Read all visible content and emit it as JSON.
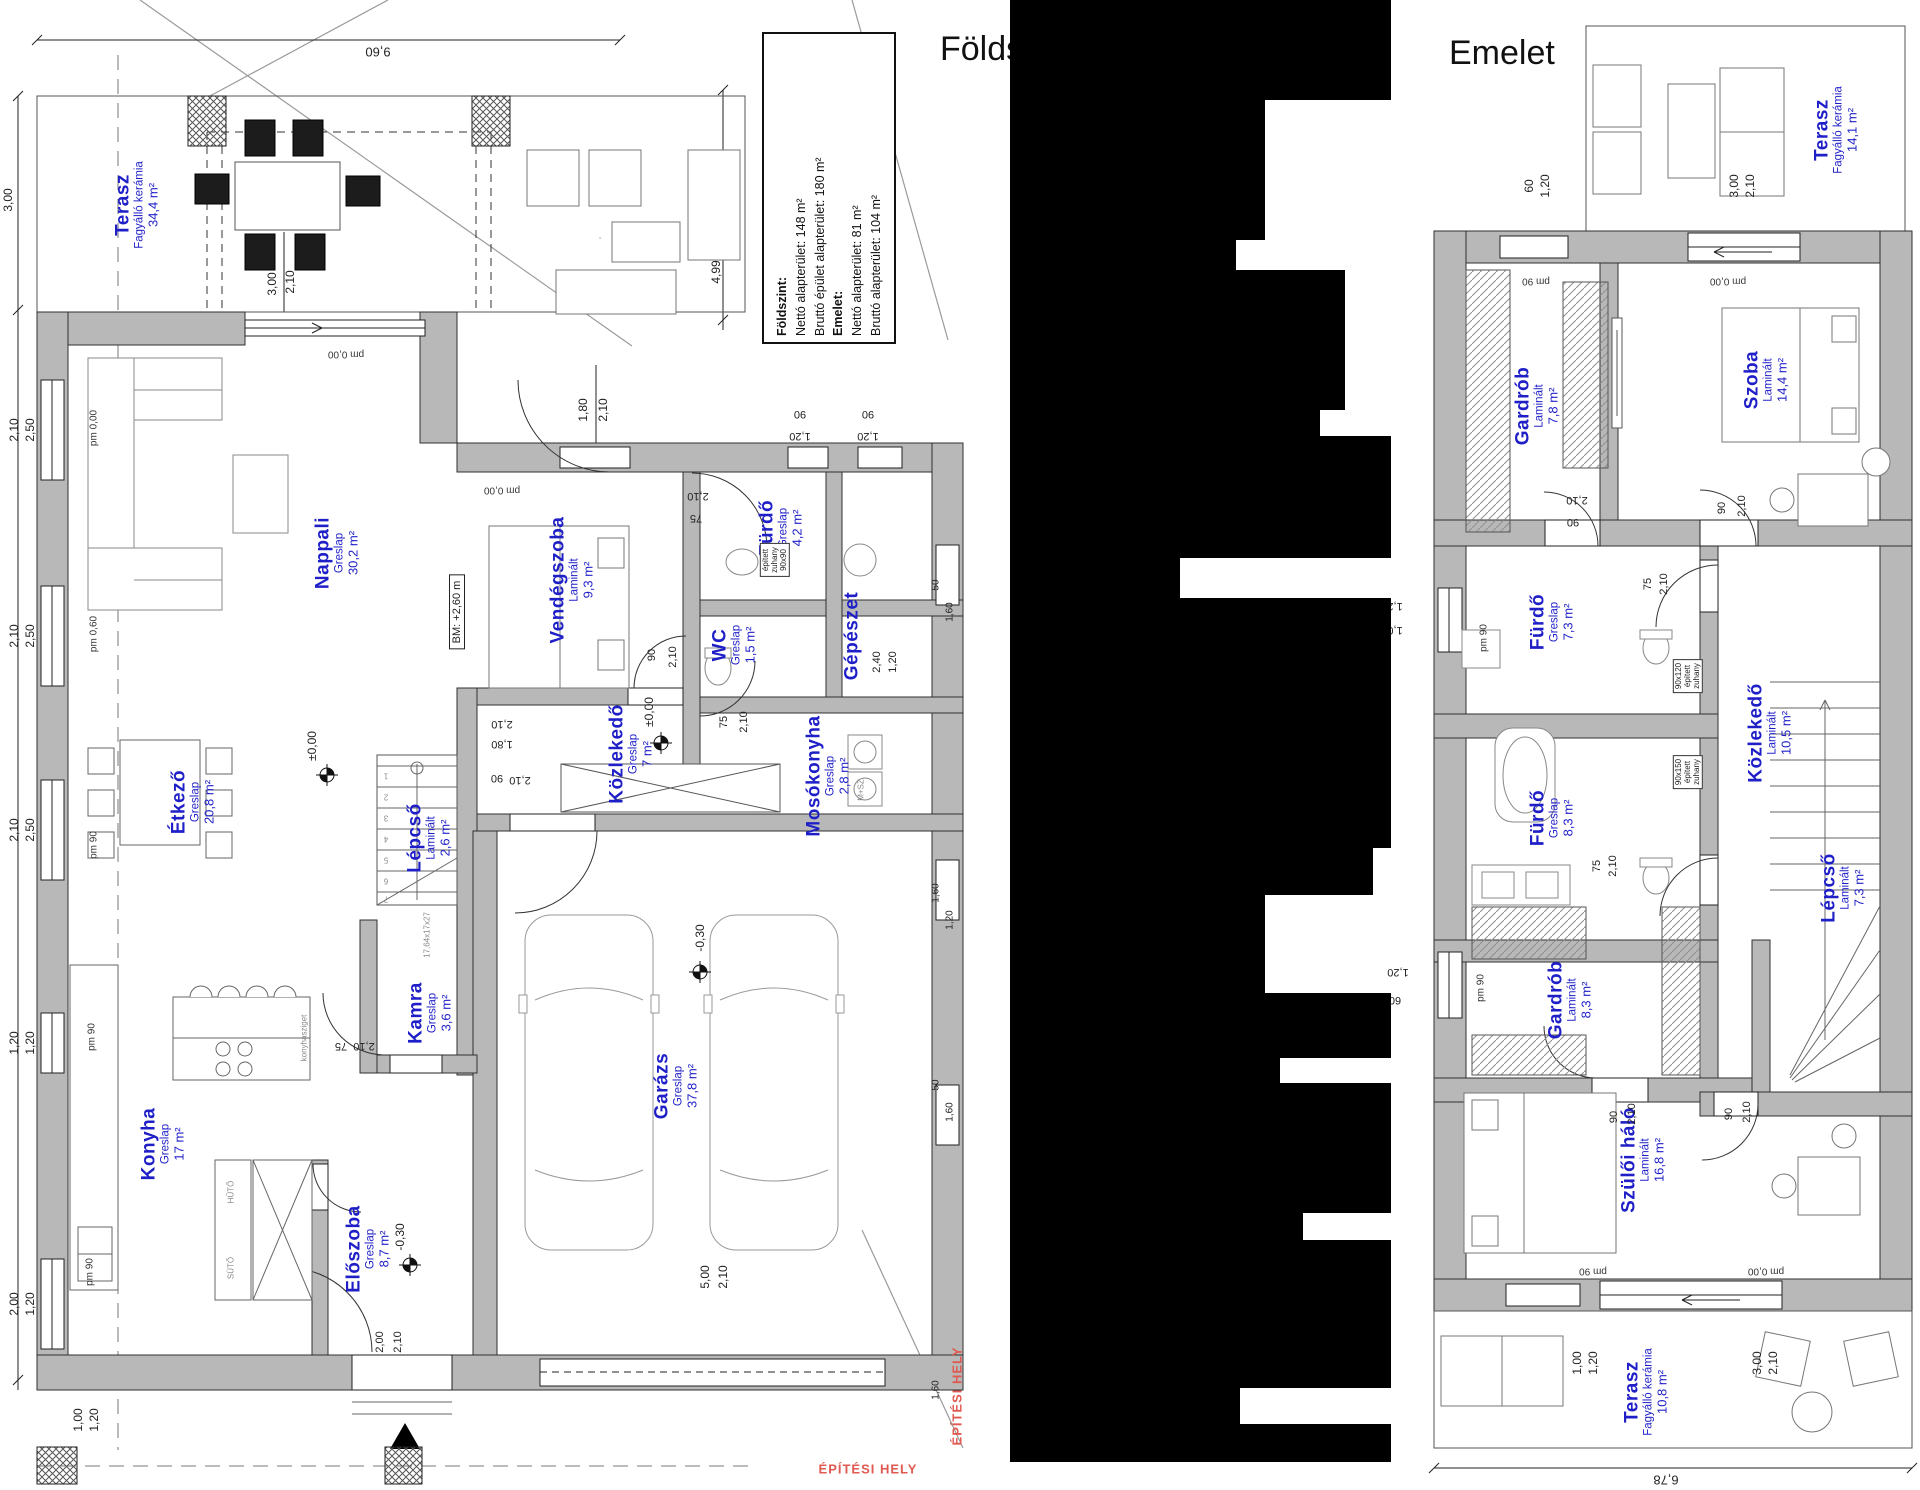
{
  "ground_floor": {
    "title": "Földszint",
    "summary_box": {
      "lines": [
        "Földszint:",
        "Nettó alapterület: 148 m²",
        "Bruttó épület alapterület: 180 m²",
        "Emelet:",
        "Nettó alapterület: 81 m²",
        "Bruttó alapterület: 104 m²"
      ]
    },
    "rooms": [
      {
        "name": "Terasz",
        "material": "Fagyálló kerámia",
        "area": "34,4 m²",
        "x": 137,
        "y": 205
      },
      {
        "name": "Nappali",
        "material": "Greslap",
        "area": "30,2 m²",
        "x": 337,
        "y": 553
      },
      {
        "name": "Vendégszoba",
        "material": "Laminált",
        "area": "9,3 m²",
        "x": 572,
        "y": 580
      },
      {
        "name": "Fürdő",
        "material": "Greslap",
        "area": "4,2 m²",
        "x": 781,
        "y": 528
      },
      {
        "name": "WC",
        "material": "Greslap",
        "area": "1,5 m²",
        "x": 734,
        "y": 645
      },
      {
        "name": "Gépészet",
        "material": "",
        "area": "",
        "x": 852,
        "y": 636
      },
      {
        "name": "Mosókonyha",
        "material": "Greslap",
        "area": "2,8 m²",
        "x": 828,
        "y": 776
      },
      {
        "name": "Közlekedő",
        "material": "Greslap",
        "area": "7 m²",
        "x": 631,
        "y": 754
      },
      {
        "name": "Étkező",
        "material": "Greslap",
        "area": "20,8 m²",
        "x": 193,
        "y": 802
      },
      {
        "name": "Lépcső",
        "material": "Laminált",
        "area": "2,6 m²",
        "x": 429,
        "y": 838
      },
      {
        "name": "Kamra",
        "material": "Greslap",
        "area": "3,6 m²",
        "x": 430,
        "y": 1013
      },
      {
        "name": "Garázs",
        "material": "Greslap",
        "area": "37,8 m²",
        "x": 676,
        "y": 1086
      },
      {
        "name": "Konyha",
        "material": "Greslap",
        "area": "17 m²",
        "x": 163,
        "y": 1144
      },
      {
        "name": "Előszoba",
        "material": "Greslap",
        "area": "8,7 m²",
        "x": 368,
        "y": 1249
      }
    ],
    "annotations": [
      {
        "t": "9,60",
        "x": 378,
        "y": 52,
        "r": 180,
        "s": 13
      },
      {
        "t": "3,00",
        "x": 8,
        "y": 200,
        "r": -90,
        "s": 12
      },
      {
        "t": "4,99",
        "x": 716,
        "y": 272,
        "r": -90,
        "s": 12
      },
      {
        "t": "3,00",
        "x": 272,
        "y": 284,
        "r": -90,
        "s": 12
      },
      {
        "t": "2,10",
        "x": 290,
        "y": 282,
        "r": -90,
        "s": 12
      },
      {
        "t": "pm 0,00",
        "x": 346,
        "y": 354,
        "r": 180,
        "s": 10,
        "c": "pm"
      },
      {
        "t": "1,80",
        "x": 583,
        "y": 410,
        "r": -90,
        "s": 12
      },
      {
        "t": "2,10",
        "x": 603,
        "y": 410,
        "r": -90,
        "s": 12
      },
      {
        "t": "90",
        "x": 800,
        "y": 414,
        "r": 180,
        "s": 11
      },
      {
        "t": "1,20",
        "x": 800,
        "y": 436,
        "r": 180,
        "s": 11
      },
      {
        "t": "90",
        "x": 868,
        "y": 414,
        "r": 180,
        "s": 11
      },
      {
        "t": "1,20",
        "x": 868,
        "y": 436,
        "r": 180,
        "s": 11
      },
      {
        "t": "pm 0,00",
        "x": 502,
        "y": 490,
        "r": 180,
        "s": 10,
        "c": "pm"
      },
      {
        "t": "2,10",
        "x": 698,
        "y": 496,
        "r": 180,
        "s": 11
      },
      {
        "t": "75",
        "x": 696,
        "y": 518,
        "r": 180,
        "s": 11
      },
      {
        "t": "2,10",
        "x": 14,
        "y": 430,
        "r": -90,
        "s": 12
      },
      {
        "t": "2,50",
        "x": 30,
        "y": 430,
        "r": -90,
        "s": 12
      },
      {
        "t": "pm 0,00",
        "x": 94,
        "y": 428,
        "r": -90,
        "s": 10,
        "c": "pm"
      },
      {
        "t": "BM: +2,60 m",
        "x": 457,
        "y": 612,
        "r": -90,
        "s": 11,
        "b": 1
      },
      {
        "t": "2,10",
        "x": 14,
        "y": 636,
        "r": -90,
        "s": 12
      },
      {
        "t": "2,50",
        "x": 30,
        "y": 636,
        "r": -90,
        "s": 12
      },
      {
        "t": "pm 0,60",
        "x": 94,
        "y": 634,
        "r": -90,
        "s": 10,
        "c": "pm"
      },
      {
        "t": "90",
        "x": 652,
        "y": 655,
        "r": -90,
        "s": 11
      },
      {
        "t": "2,10",
        "x": 673,
        "y": 657,
        "r": -90,
        "s": 11
      },
      {
        "t": "75",
        "x": 724,
        "y": 722,
        "r": -90,
        "s": 11
      },
      {
        "t": "2,10",
        "x": 744,
        "y": 722,
        "r": -90,
        "s": 11
      },
      {
        "t": "2,40",
        "x": 877,
        "y": 662,
        "r": -90,
        "s": 11
      },
      {
        "t": "1,20",
        "x": 893,
        "y": 662,
        "r": -90,
        "s": 11
      },
      {
        "t": "50",
        "x": 936,
        "y": 585,
        "r": -90,
        "s": 10
      },
      {
        "t": "1,60",
        "x": 950,
        "y": 612,
        "r": -90,
        "s": 10
      },
      {
        "t": "±0,00",
        "x": 649,
        "y": 712,
        "r": -90,
        "s": 12
      },
      {
        "t": "±0,00",
        "x": 312,
        "y": 746,
        "r": -90,
        "s": 12
      },
      {
        "t": "2,10",
        "x": 502,
        "y": 724,
        "r": 180,
        "s": 11
      },
      {
        "t": "1,80",
        "x": 502,
        "y": 744,
        "r": 180,
        "s": 11
      },
      {
        "t": "90",
        "x": 497,
        "y": 778,
        "r": 180,
        "s": 11
      },
      {
        "t": "2,10",
        "x": 520,
        "y": 780,
        "r": 180,
        "s": 11
      },
      {
        "t": "M+SZ",
        "x": 861,
        "y": 790,
        "r": -90,
        "s": 8,
        "c": "gray"
      },
      {
        "t": "2,10",
        "x": 14,
        "y": 830,
        "r": -90,
        "s": 12
      },
      {
        "t": "2,50",
        "x": 30,
        "y": 830,
        "r": -90,
        "s": 12
      },
      {
        "t": "pm 90",
        "x": 94,
        "y": 845,
        "r": -90,
        "s": 10,
        "c": "pm"
      },
      {
        "t": "1",
        "x": 386,
        "y": 776,
        "r": 180,
        "s": 8,
        "c": "gray"
      },
      {
        "t": "2",
        "x": 386,
        "y": 797,
        "r": 180,
        "s": 8,
        "c": "gray"
      },
      {
        "t": "3",
        "x": 386,
        "y": 818,
        "r": 180,
        "s": 8,
        "c": "gray"
      },
      {
        "t": "4",
        "x": 386,
        "y": 839,
        "r": 180,
        "s": 8,
        "c": "gray"
      },
      {
        "t": "5",
        "x": 386,
        "y": 860,
        "r": 180,
        "s": 8,
        "c": "gray"
      },
      {
        "t": "6",
        "x": 386,
        "y": 881,
        "r": 180,
        "s": 8,
        "c": "gray"
      },
      {
        "t": "7",
        "x": 386,
        "y": 899,
        "r": 180,
        "s": 8,
        "c": "gray"
      },
      {
        "t": "17,64x17x27",
        "x": 427,
        "y": 935,
        "r": -90,
        "s": 8,
        "c": "gray"
      },
      {
        "t": "-0,30",
        "x": 700,
        "y": 938,
        "r": -90,
        "s": 12
      },
      {
        "t": "1,60",
        "x": 936,
        "y": 893,
        "r": -90,
        "s": 10
      },
      {
        "t": "1,20",
        "x": 950,
        "y": 920,
        "r": -90,
        "s": 10
      },
      {
        "t": "75",
        "x": 341,
        "y": 1046,
        "r": 180,
        "s": 11
      },
      {
        "t": "2,10",
        "x": 364,
        "y": 1046,
        "r": 180,
        "s": 11
      },
      {
        "t": "1,20",
        "x": 14,
        "y": 1043,
        "r": -90,
        "s": 12
      },
      {
        "t": "1,20",
        "x": 30,
        "y": 1043,
        "r": -90,
        "s": 12
      },
      {
        "t": "pm 90",
        "x": 92,
        "y": 1037,
        "r": -90,
        "s": 10,
        "c": "pm"
      },
      {
        "t": "konyhasziget",
        "x": 304,
        "y": 1038,
        "r": -90,
        "s": 8,
        "c": "gray"
      },
      {
        "t": "HŰTŐ",
        "x": 231,
        "y": 1192,
        "r": -90,
        "s": 8,
        "c": "gray"
      },
      {
        "t": "SÜTŐ",
        "x": 231,
        "y": 1268,
        "r": -90,
        "s": 8,
        "c": "gray"
      },
      {
        "t": "50",
        "x": 936,
        "y": 1085,
        "r": -90,
        "s": 10
      },
      {
        "t": "1,60",
        "x": 950,
        "y": 1112,
        "r": -90,
        "s": 10
      },
      {
        "t": "-0,30",
        "x": 400,
        "y": 1237,
        "r": -90,
        "s": 12
      },
      {
        "t": "5,00",
        "x": 705,
        "y": 1277,
        "r": -90,
        "s": 12
      },
      {
        "t": "2,10",
        "x": 723,
        "y": 1277,
        "r": -90,
        "s": 12
      },
      {
        "t": "2,00",
        "x": 14,
        "y": 1304,
        "r": -90,
        "s": 12
      },
      {
        "t": "1,20",
        "x": 30,
        "y": 1304,
        "r": -90,
        "s": 12
      },
      {
        "t": "pm 90",
        "x": 90,
        "y": 1272,
        "r": -90,
        "s": 10,
        "c": "pm"
      },
      {
        "t": "2,00",
        "x": 380,
        "y": 1342,
        "r": -90,
        "s": 11
      },
      {
        "t": "2,10",
        "x": 398,
        "y": 1342,
        "r": -90,
        "s": 11
      },
      {
        "t": "1,00",
        "x": 78,
        "y": 1420,
        "r": -90,
        "s": 12
      },
      {
        "t": "1,20",
        "x": 94,
        "y": 1420,
        "r": -90,
        "s": 12
      },
      {
        "t": "1,60",
        "x": 936,
        "y": 1390,
        "r": -90,
        "s": 10
      },
      {
        "t": "ÉPÍTÉSI HELY",
        "x": 957,
        "y": 1396,
        "r": -90,
        "s": 13,
        "c": "red"
      },
      {
        "t": "ÉPÍTÉSI HELY",
        "x": 868,
        "y": 1469,
        "r": 0,
        "s": 13,
        "c": "red"
      },
      {
        "lines": [
          "épített",
          "zuhany",
          "90x90"
        ],
        "x": 775,
        "y": 560,
        "r": -90,
        "s": 8
      }
    ]
  },
  "upper_floor": {
    "title": "Emelet",
    "rooms": [
      {
        "name": "Terasz",
        "material": "Fagyálló kerámia",
        "area": "14,1 m²",
        "x": 1836,
        "y": 130
      },
      {
        "name": "Gardrób",
        "material": "Laminált",
        "area": "7,8 m²",
        "x": 1537,
        "y": 406
      },
      {
        "name": "Szoba",
        "material": "Laminált",
        "area": "14,4 m²",
        "x": 1766,
        "y": 380
      },
      {
        "name": "Fürdő",
        "material": "Greslap",
        "area": "7,3 m²",
        "x": 1552,
        "y": 622
      },
      {
        "name": "Közlekedő",
        "material": "Laminált",
        "area": "10,5 m²",
        "x": 1770,
        "y": 733
      },
      {
        "name": "Fürdő",
        "material": "Greslap",
        "area": "8,3 m²",
        "x": 1552,
        "y": 818
      },
      {
        "name": "Lépcső",
        "material": "Laminált",
        "area": "7,3 m²",
        "x": 1843,
        "y": 888
      },
      {
        "name": "Gardrób",
        "material": "Laminált",
        "area": "8,3 m²",
        "x": 1570,
        "y": 1000
      },
      {
        "name": "Szülői háló",
        "material": "Laminált",
        "area": "16,8 m²",
        "x": 1643,
        "y": 1160
      },
      {
        "name": "Terasz",
        "material": "Fagyálló kerámia",
        "area": "10,8 m²",
        "x": 1646,
        "y": 1392
      }
    ],
    "annotations": [
      {
        "t": "60",
        "x": 1529,
        "y": 186,
        "r": -90,
        "s": 12
      },
      {
        "t": "1,20",
        "x": 1545,
        "y": 186,
        "r": -90,
        "s": 12
      },
      {
        "t": "3,00",
        "x": 1734,
        "y": 186,
        "r": -90,
        "s": 12
      },
      {
        "t": "2,10",
        "x": 1750,
        "y": 186,
        "r": -90,
        "s": 12
      },
      {
        "t": "pm 90",
        "x": 1536,
        "y": 281,
        "r": 180,
        "s": 10,
        "c": "pm"
      },
      {
        "t": "pm 0,00",
        "x": 1728,
        "y": 281,
        "r": 180,
        "s": 10,
        "c": "pm"
      },
      {
        "t": "2,10",
        "x": 1577,
        "y": 500,
        "r": 180,
        "s": 11
      },
      {
        "t": "90",
        "x": 1573,
        "y": 522,
        "r": 180,
        "s": 11
      },
      {
        "t": "90",
        "x": 1722,
        "y": 508,
        "r": -90,
        "s": 11
      },
      {
        "t": "2,10",
        "x": 1742,
        "y": 506,
        "r": -90,
        "s": 11
      },
      {
        "t": "75",
        "x": 1648,
        "y": 584,
        "r": -90,
        "s": 11
      },
      {
        "t": "2,10",
        "x": 1664,
        "y": 584,
        "r": -90,
        "s": 11
      },
      {
        "t": "1,20",
        "x": 1392,
        "y": 606,
        "r": 180,
        "s": 11
      },
      {
        "t": "1,00",
        "x": 1392,
        "y": 630,
        "r": 180,
        "s": 11
      },
      {
        "t": "pm 90",
        "x": 1484,
        "y": 638,
        "r": -90,
        "s": 10,
        "c": "pm"
      },
      {
        "lines": [
          "90x120",
          "épített",
          "zuhany"
        ],
        "x": 1688,
        "y": 676,
        "r": -90,
        "s": 8
      },
      {
        "lines": [
          "90x150",
          "épített",
          "zuhany"
        ],
        "x": 1688,
        "y": 772,
        "r": -90,
        "s": 8
      },
      {
        "t": "75",
        "x": 1597,
        "y": 866,
        "r": -90,
        "s": 11
      },
      {
        "t": "2,10",
        "x": 1613,
        "y": 866,
        "r": -90,
        "s": 11
      },
      {
        "t": "1,20",
        "x": 1398,
        "y": 972,
        "r": 180,
        "s": 11
      },
      {
        "t": "60",
        "x": 1395,
        "y": 1000,
        "r": 180,
        "s": 11
      },
      {
        "t": "pm 90",
        "x": 1481,
        "y": 988,
        "r": -90,
        "s": 10,
        "c": "pm"
      },
      {
        "t": "90",
        "x": 1614,
        "y": 1117,
        "r": -90,
        "s": 11
      },
      {
        "t": "2,10",
        "x": 1632,
        "y": 1114,
        "r": -90,
        "s": 11
      },
      {
        "t": "90",
        "x": 1729,
        "y": 1114,
        "r": -90,
        "s": 11
      },
      {
        "t": "2,10",
        "x": 1747,
        "y": 1112,
        "r": -90,
        "s": 11
      },
      {
        "t": "pm 90",
        "x": 1593,
        "y": 1271,
        "r": 180,
        "s": 10,
        "c": "pm"
      },
      {
        "t": "pm 0,00",
        "x": 1766,
        "y": 1271,
        "r": 180,
        "s": 10,
        "c": "pm"
      },
      {
        "t": "1,00",
        "x": 1577,
        "y": 1363,
        "r": -90,
        "s": 12
      },
      {
        "t": "1,20",
        "x": 1593,
        "y": 1363,
        "r": -90,
        "s": 12
      },
      {
        "t": "3,00",
        "x": 1757,
        "y": 1363,
        "r": -90,
        "s": 12
      },
      {
        "t": "2,10",
        "x": 1773,
        "y": 1363,
        "r": -90,
        "s": 12
      },
      {
        "t": "6,78",
        "x": 1666,
        "y": 1480,
        "r": 180,
        "s": 13
      }
    ]
  }
}
